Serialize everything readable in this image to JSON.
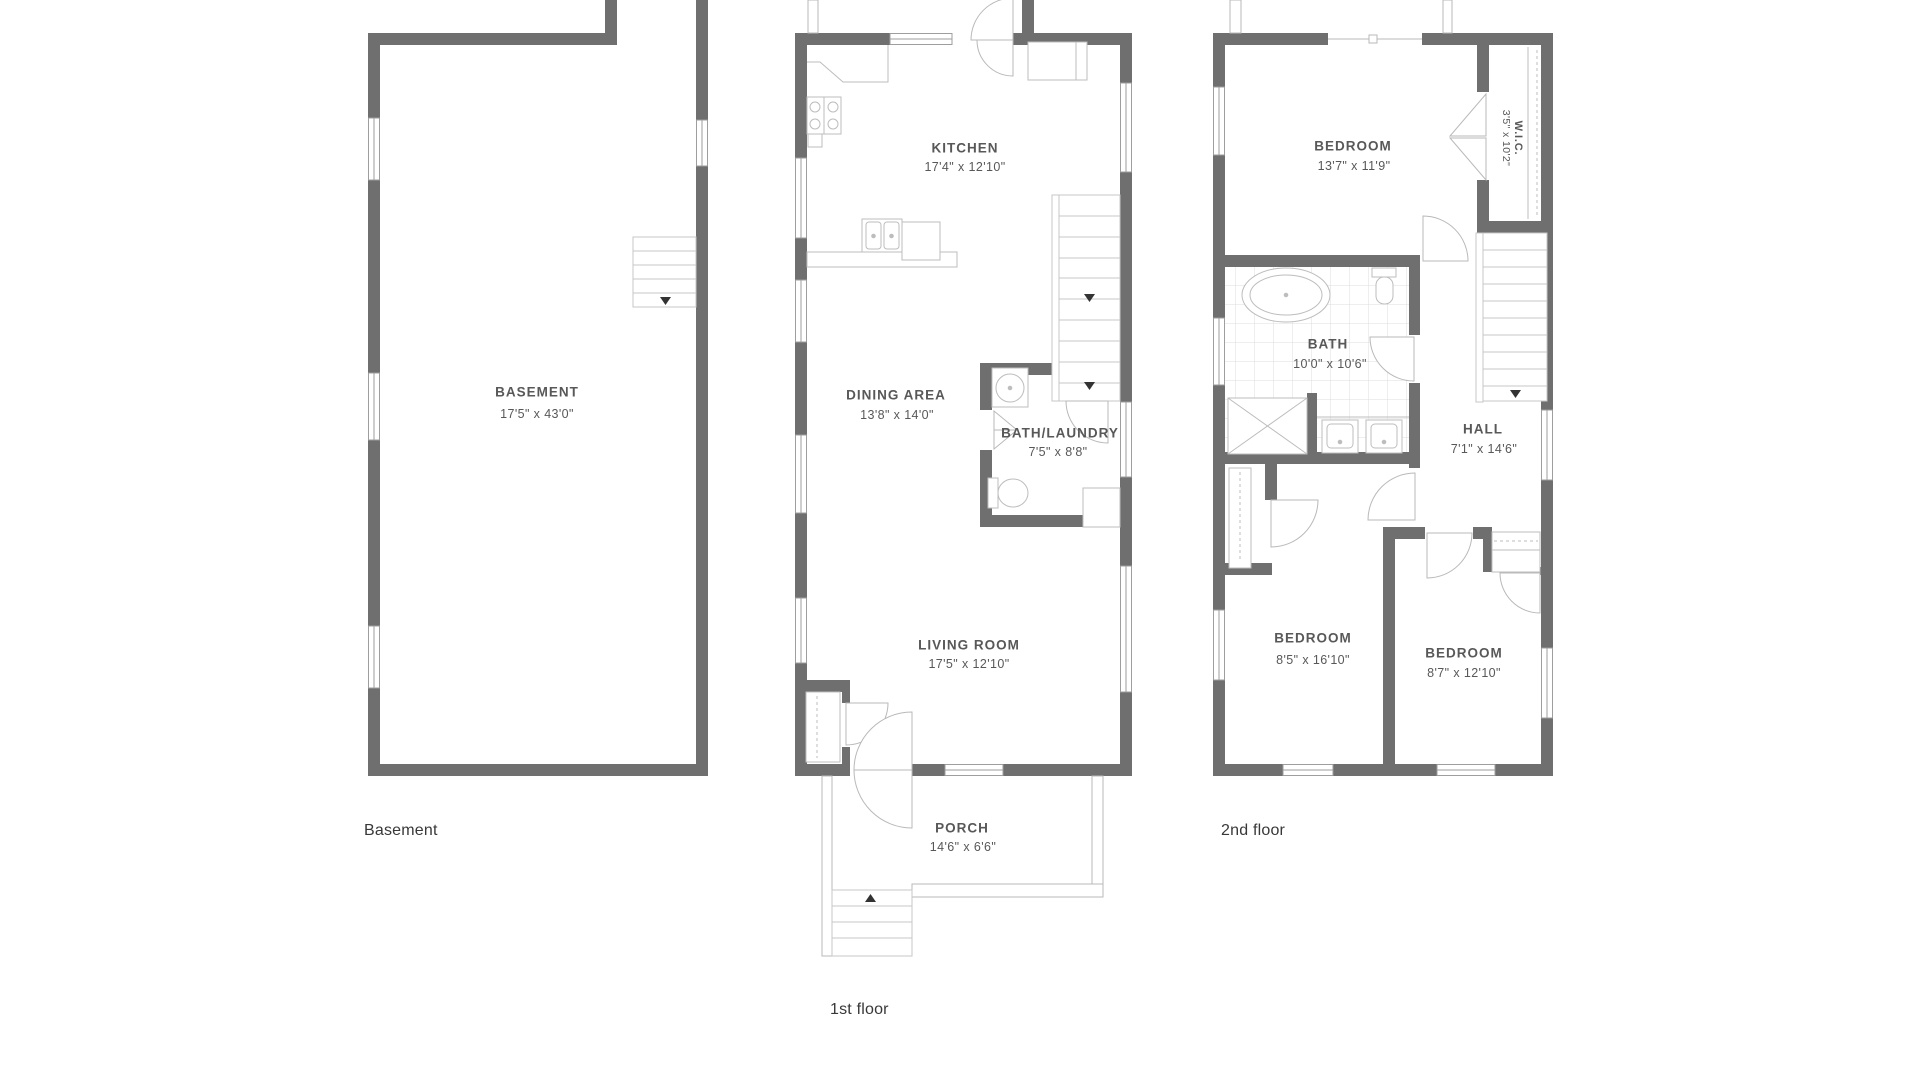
{
  "document_type": "residential floor plan set",
  "colors": {
    "wall": "#6f6f6f",
    "thin_line": "#b9b9b9",
    "text": "#585858",
    "floor_label_text": "#383838"
  },
  "plans": {
    "basement": {
      "label": "Basement",
      "room": {
        "name": "BASEMENT",
        "dims": "17'5\" x 43'0\""
      }
    },
    "first": {
      "label": "1st floor",
      "kitchen": {
        "name": "KITCHEN",
        "dims": "17'4\" x 12'10\""
      },
      "dining": {
        "name": "DINING AREA",
        "dims": "13'8\" x 14'0\""
      },
      "bath_laundry": {
        "name": "BATH/LAUNDRY",
        "dims": "7'5\" x 8'8\""
      },
      "living": {
        "name": "LIVING ROOM",
        "dims": "17'5\" x 12'10\""
      },
      "porch": {
        "name": "PORCH",
        "dims": "14'6\" x 6'6\""
      }
    },
    "second": {
      "label": "2nd floor",
      "bedroom_top": {
        "name": "BEDROOM",
        "dims": "13'7\" x 11'9\""
      },
      "wic": {
        "name": "W.I.C.",
        "dims": "3'5\" x 10'2\""
      },
      "bath": {
        "name": "BATH",
        "dims": "10'0\" x 10'6\""
      },
      "hall": {
        "name": "HALL",
        "dims": "7'1\" x 14'6\""
      },
      "bedroom_left": {
        "name": "BEDROOM",
        "dims": "8'5\" x 16'10\""
      },
      "bedroom_right": {
        "name": "BEDROOM",
        "dims": "8'7\" x 12'10\""
      }
    }
  }
}
